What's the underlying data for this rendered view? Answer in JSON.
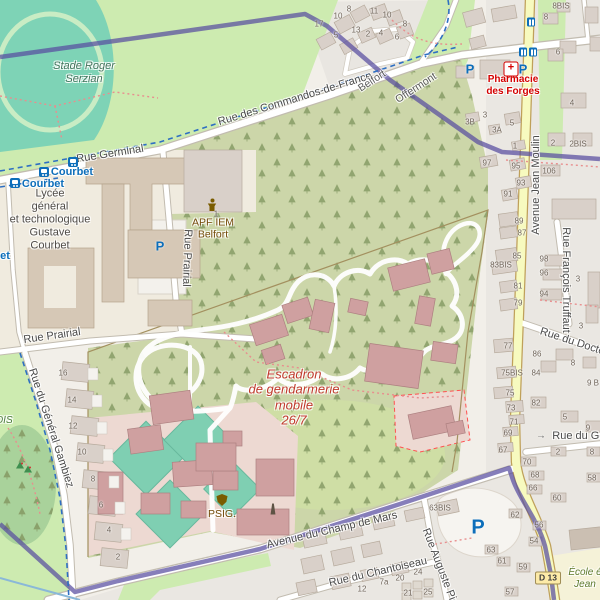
{
  "palette": {
    "boundary_purple": "#584CA0",
    "road_yellow": "#f7fabf",
    "grass_green": "#cdebb0",
    "scrub_green": "#ccd6a9",
    "wood_green": "#a9d29b",
    "pitch_teal": "#7fcfb2",
    "military_pink": "#edd9d2",
    "building_grey": "#d9d0c9",
    "building_pink": "#cfa0a0",
    "school_beige": "#f0ebdf",
    "poi_brown": "#734a08",
    "military_label_red": "#c0392b",
    "transit_blue": "#0d6eba",
    "pharmacy_red": "#d40000"
  },
  "icon_glyphs": {
    "parking": "P",
    "pharmacy": "+",
    "arrow": "→"
  },
  "street_labels": [
    {
      "text": "Rue Germinal",
      "x": 110,
      "y": 154,
      "rot": -9,
      "cls": "st"
    },
    {
      "text": "Rue des Commandos-de-France",
      "x": 295,
      "y": 99,
      "rot": -17,
      "cls": "st"
    },
    {
      "text": "Belfort",
      "x": 372,
      "y": 81,
      "rot": -33,
      "cls": "dest"
    },
    {
      "text": "Offermont",
      "x": 416,
      "y": 88,
      "rot": -33,
      "cls": "dest"
    },
    {
      "text": "Avenue Jean Moulin",
      "x": 536,
      "y": 185,
      "rot": -90,
      "cls": "st"
    },
    {
      "text": "Rue François Truffaut",
      "x": 566,
      "y": 280,
      "rot": 90,
      "cls": "st"
    },
    {
      "text": "Rue du Docteur",
      "x": 577,
      "y": 343,
      "rot": 18,
      "cls": "st"
    },
    {
      "text": "Rue du Géné",
      "x": 585,
      "y": 436,
      "rot": 0,
      "cls": "st"
    },
    {
      "text": "Rue Prairial",
      "x": 52,
      "y": 336,
      "rot": -8,
      "cls": "st"
    },
    {
      "text": "Rue Prairial",
      "x": 187,
      "y": 258,
      "rot": 92,
      "cls": "st"
    },
    {
      "text": "Rue du Général Gambiez",
      "x": 51,
      "y": 428,
      "rot": 72,
      "cls": "st"
    },
    {
      "text": "Avenue du Champ de Mars",
      "x": 332,
      "y": 530,
      "rot": -13,
      "cls": "st"
    },
    {
      "text": "Rue du Chantoiseau",
      "x": 378,
      "y": 572,
      "rot": -13,
      "cls": "st"
    },
    {
      "text": "Rue Auguste Pie",
      "x": 440,
      "y": 567,
      "rot": 69,
      "cls": "st"
    }
  ],
  "poi_labels": [
    {
      "name": "stade",
      "cls": "leisure",
      "x": 84,
      "y": 73,
      "lines": [
        "Stade Roger",
        "Serzian"
      ]
    },
    {
      "name": "lycee",
      "cls": "school-lbl",
      "x": 50,
      "y": 220,
      "lines": [
        "Lycée",
        "général",
        "et technologique",
        "Gustave",
        "Courbet"
      ]
    },
    {
      "name": "apf",
      "cls": "brown",
      "x": 213,
      "y": 229,
      "lines": [
        "APF IEM",
        "Belfort"
      ]
    },
    {
      "name": "escadron",
      "cls": "red-mil",
      "x": 294,
      "y": 397,
      "lines": [
        "Escadron",
        "de gendarmerie",
        "mobile",
        "26/7"
      ]
    },
    {
      "name": "pharmacie",
      "cls": "red-pharm",
      "x": 513,
      "y": 86,
      "lines": [
        "Pharmacie",
        "des Forges"
      ]
    },
    {
      "name": "psig",
      "cls": "brown",
      "x": 222,
      "y": 514,
      "lines": [
        "PSIG."
      ]
    },
    {
      "name": "ecole",
      "cls": "green-sch",
      "x": 585,
      "y": 579,
      "lines": [
        "École é",
        "Jean"
      ]
    },
    {
      "name": "bois",
      "cls": "green-wood",
      "x": 4,
      "y": 421,
      "lines": [
        "OIS"
      ]
    }
  ],
  "transit_labels": [
    {
      "text": "Courbet",
      "x": 72,
      "y": 172
    },
    {
      "text": "Courbet",
      "x": 43,
      "y": 184
    },
    {
      "text": "et",
      "x": 5,
      "y": 256
    }
  ],
  "house_numbers": [
    {
      "t": "17",
      "x": 319,
      "y": 24
    },
    {
      "t": "10",
      "x": 338,
      "y": 16
    },
    {
      "t": "8",
      "x": 349,
      "y": 9
    },
    {
      "t": "11",
      "x": 374,
      "y": 11
    },
    {
      "t": "10",
      "x": 387,
      "y": 15
    },
    {
      "t": "5",
      "x": 336,
      "y": 35
    },
    {
      "t": "13",
      "x": 356,
      "y": 30
    },
    {
      "t": "2",
      "x": 368,
      "y": 34
    },
    {
      "t": "4",
      "x": 381,
      "y": 33
    },
    {
      "t": "6",
      "x": 397,
      "y": 37
    },
    {
      "t": "8",
      "x": 405,
      "y": 24
    },
    {
      "t": "8BIS",
      "x": 561,
      "y": 6
    },
    {
      "t": "8",
      "x": 546,
      "y": 17
    },
    {
      "t": "6",
      "x": 558,
      "y": 52
    },
    {
      "t": "4",
      "x": 572,
      "y": 103
    },
    {
      "t": "2",
      "x": 553,
      "y": 143
    },
    {
      "t": "2BIS",
      "x": 578,
      "y": 144
    },
    {
      "t": "3B",
      "x": 470,
      "y": 122
    },
    {
      "t": "3",
      "x": 485,
      "y": 115
    },
    {
      "t": "3A",
      "x": 497,
      "y": 130
    },
    {
      "t": "5",
      "x": 512,
      "y": 123
    },
    {
      "t": "1",
      "x": 515,
      "y": 146
    },
    {
      "t": "97",
      "x": 487,
      "y": 163
    },
    {
      "t": "95",
      "x": 516,
      "y": 166
    },
    {
      "t": "106",
      "x": 549,
      "y": 171
    },
    {
      "t": "93",
      "x": 521,
      "y": 183
    },
    {
      "t": "91",
      "x": 508,
      "y": 194
    },
    {
      "t": "89",
      "x": 519,
      "y": 221
    },
    {
      "t": "87",
      "x": 522,
      "y": 233
    },
    {
      "t": "85",
      "x": 517,
      "y": 256
    },
    {
      "t": "83BIS",
      "x": 501,
      "y": 265
    },
    {
      "t": "81",
      "x": 518,
      "y": 286
    },
    {
      "t": "79",
      "x": 518,
      "y": 303
    },
    {
      "t": "77",
      "x": 508,
      "y": 346
    },
    {
      "t": "75BIS",
      "x": 512,
      "y": 373
    },
    {
      "t": "75",
      "x": 510,
      "y": 393
    },
    {
      "t": "98",
      "x": 544,
      "y": 259
    },
    {
      "t": "96",
      "x": 544,
      "y": 273
    },
    {
      "t": "94",
      "x": 544,
      "y": 294
    },
    {
      "t": "3",
      "x": 578,
      "y": 279
    },
    {
      "t": "3",
      "x": 581,
      "y": 326
    },
    {
      "t": "86",
      "x": 537,
      "y": 354
    },
    {
      "t": "8",
      "x": 573,
      "y": 363
    },
    {
      "t": "84",
      "x": 536,
      "y": 373
    },
    {
      "t": "9 B",
      "x": 593,
      "y": 383
    },
    {
      "t": "73",
      "x": 511,
      "y": 408
    },
    {
      "t": "71",
      "x": 514,
      "y": 422
    },
    {
      "t": "69",
      "x": 508,
      "y": 433
    },
    {
      "t": "67",
      "x": 503,
      "y": 450
    },
    {
      "t": "82",
      "x": 536,
      "y": 403
    },
    {
      "t": "5",
      "x": 565,
      "y": 417
    },
    {
      "t": "9",
      "x": 588,
      "y": 428
    },
    {
      "t": "2",
      "x": 558,
      "y": 452
    },
    {
      "t": "8",
      "x": 592,
      "y": 452
    },
    {
      "t": "70",
      "x": 527,
      "y": 462
    },
    {
      "t": "68",
      "x": 535,
      "y": 475
    },
    {
      "t": "66",
      "x": 533,
      "y": 488
    },
    {
      "t": "58",
      "x": 592,
      "y": 478
    },
    {
      "t": "60",
      "x": 557,
      "y": 498
    },
    {
      "t": "62",
      "x": 515,
      "y": 515
    },
    {
      "t": "56",
      "x": 539,
      "y": 525
    },
    {
      "t": "54",
      "x": 534,
      "y": 541
    },
    {
      "t": "63BIS",
      "x": 440,
      "y": 508
    },
    {
      "t": "63",
      "x": 491,
      "y": 550
    },
    {
      "t": "61",
      "x": 502,
      "y": 561
    },
    {
      "t": "59",
      "x": 523,
      "y": 567
    },
    {
      "t": "57",
      "x": 510,
      "y": 592
    },
    {
      "t": "24",
      "x": 418,
      "y": 572
    },
    {
      "t": "25",
      "x": 428,
      "y": 592
    },
    {
      "t": "20",
      "x": 400,
      "y": 578
    },
    {
      "t": "7a",
      "x": 384,
      "y": 582
    },
    {
      "t": "12",
      "x": 362,
      "y": 589
    },
    {
      "t": "21",
      "x": 408,
      "y": 593
    },
    {
      "t": "16",
      "x": 63,
      "y": 373
    },
    {
      "t": "14",
      "x": 72,
      "y": 400
    },
    {
      "t": "12",
      "x": 73,
      "y": 426
    },
    {
      "t": "10",
      "x": 82,
      "y": 452
    },
    {
      "t": "8",
      "x": 93,
      "y": 479
    },
    {
      "t": "6",
      "x": 101,
      "y": 505
    },
    {
      "t": "4",
      "x": 109,
      "y": 530
    },
    {
      "t": "2",
      "x": 118,
      "y": 557
    },
    {
      "t": "1",
      "x": 216,
      "y": 214
    }
  ],
  "icons": [
    {
      "type": "parking",
      "x": 470,
      "y": 69,
      "s": 13
    },
    {
      "type": "parking",
      "x": 523,
      "y": 69,
      "s": 13
    },
    {
      "type": "parking",
      "x": 160,
      "y": 246,
      "s": 13
    },
    {
      "type": "parking",
      "x": 478,
      "y": 528,
      "s": 20
    },
    {
      "type": "pharmacy",
      "x": 511,
      "y": 69
    },
    {
      "type": "tram",
      "x": 73,
      "y": 162
    },
    {
      "type": "tram",
      "x": 44,
      "y": 172
    },
    {
      "type": "tram",
      "x": 15,
      "y": 183
    },
    {
      "type": "bus",
      "x": 531,
      "y": 22
    },
    {
      "type": "bus",
      "x": 523,
      "y": 52
    },
    {
      "type": "bus",
      "x": 533,
      "y": 52
    },
    {
      "type": "police",
      "x": 222,
      "y": 500
    },
    {
      "type": "monument",
      "x": 273,
      "y": 509
    },
    {
      "type": "person",
      "x": 212,
      "y": 205
    },
    {
      "type": "arrow",
      "x": 541,
      "y": 436
    },
    {
      "type": "tree",
      "x": 20,
      "y": 466
    },
    {
      "type": "tree",
      "x": 28,
      "y": 470
    },
    {
      "type": "badge",
      "x": 548,
      "y": 578,
      "text": "D 13"
    }
  ]
}
